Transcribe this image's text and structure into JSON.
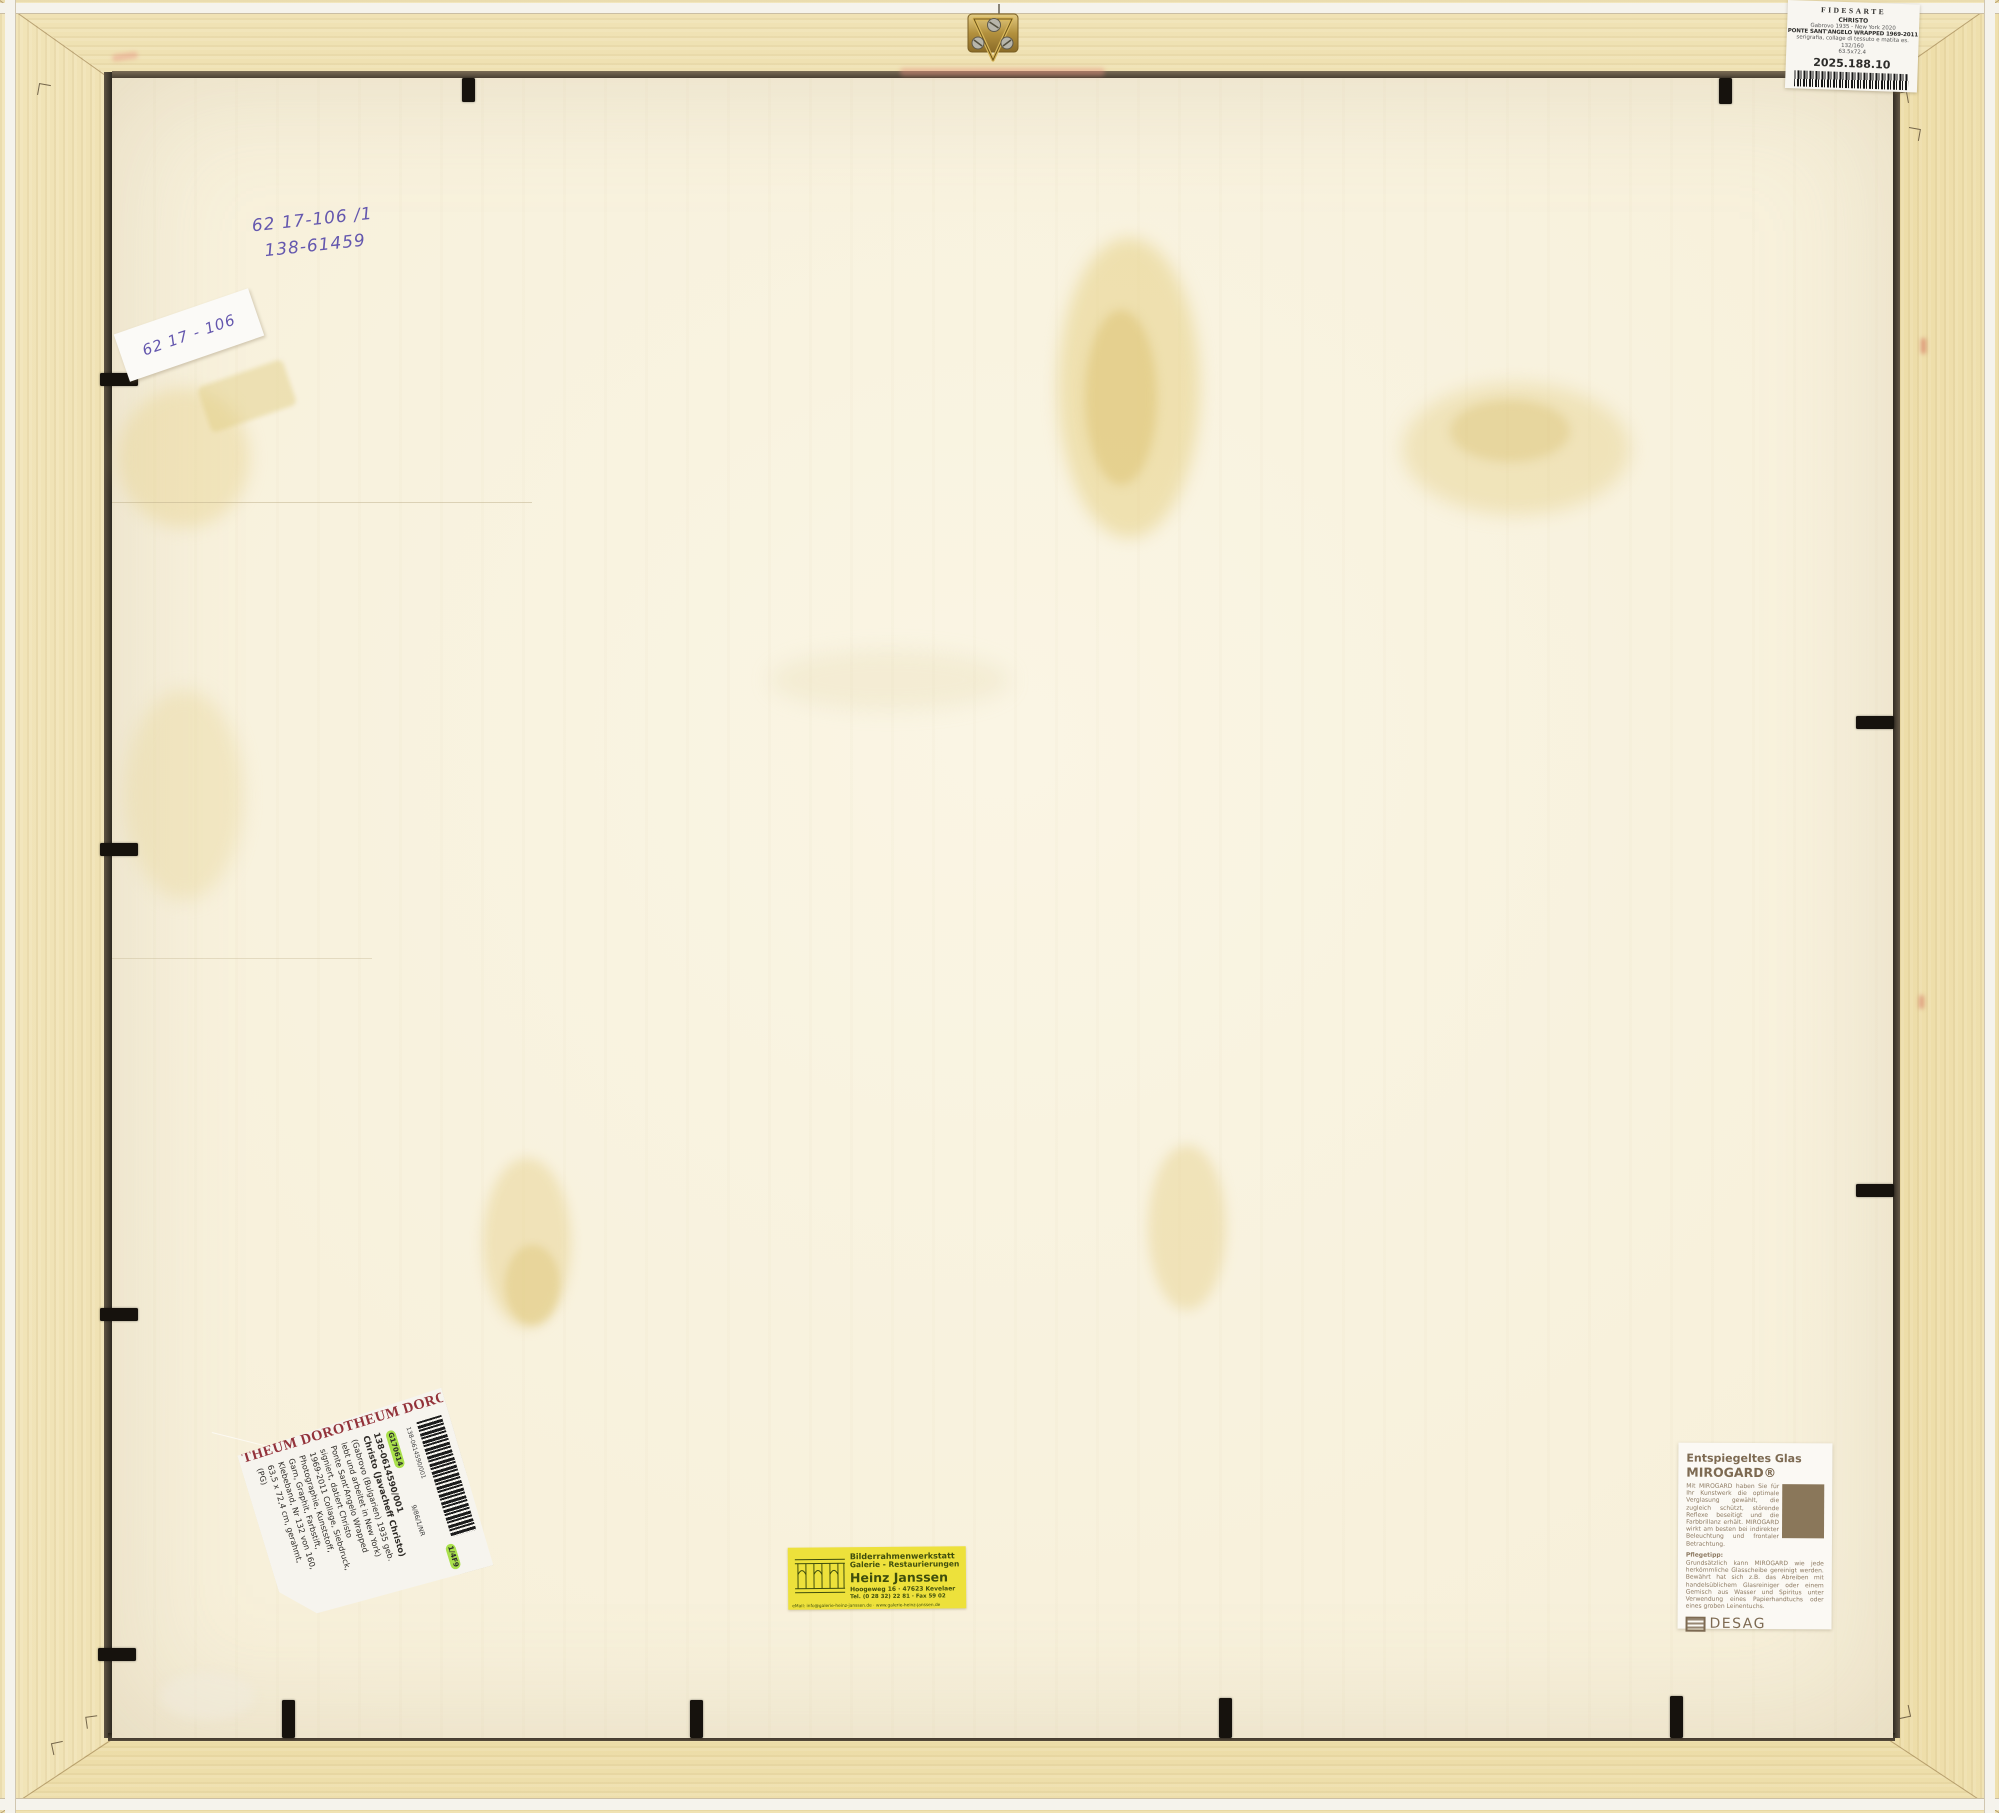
{
  "colors": {
    "wood": "#ecdca6",
    "board": "#f8f2df",
    "frame_lip": "#f5f3ec",
    "label_yellow": "#ede13b",
    "dorotheum_red": "#93323a",
    "badge_green": "#a9e04b",
    "ink_blue": "#6457ae",
    "mirogard_brown": "#7d6a52",
    "janssen_green": "#3f4e0c"
  },
  "handwriting": {
    "line1": "62 17-106 /1",
    "line2": "138-61459",
    "sticker_text": "62 17 - 106"
  },
  "fidesarte_label": {
    "brand": "FIDESARTE",
    "artist": "CHRISTO",
    "dates": "Gabrovo 1935 - New York 2020",
    "title": "PONTE SANT'ANGELO WRAPPED 1969-2011",
    "medium": "serigrafia, collage di tessuto e matita es. 132/160",
    "size": "63.5x72.4",
    "accession": "2025.188.10"
  },
  "dorotheum_label": {
    "header": "THEUM DOROTHEUM DOROTHEUM",
    "badge_top": "G170614",
    "side_number": "9/86/1/NR",
    "badge_bottom": "1/4F9",
    "barcode_number": "138-0614590/001",
    "lines": [
      "138-0614590/001",
      "Christo (Javacheff Christo)",
      "(Gabrovo (Bulgarien) 1935 geb.",
      "lebt und arbeitet in New York)",
      "Ponte Sant'Angelo Wrapped",
      "signiert, datiert Christo",
      "1969-2011 Collage, Siebdruck,",
      "Photographie, Kunststoff,",
      "Garn, Graphit, Farbstift,",
      "Klebeband, Nr 132 von 160,",
      "63,5 x 72,4 cm, gerahmt,",
      "(PG)"
    ]
  },
  "janssen_label": {
    "line1": "Bilderrahmenwerkstatt",
    "line2": "Galerie - Restaurierungen",
    "name": "Heinz Janssen",
    "address": "Hoogeweg 16 · 47623 Kevelaer",
    "phone": "Tel. (0 28 32) 22 81 · Fax 59 02",
    "email_line": "eMail: info@galerie-heinz-janssen.de · www.galerie-heinz-janssen.de"
  },
  "mirogard_label": {
    "title_line1": "Entspiegeltes Glas",
    "title_line2": "MIROGARD®",
    "intro": "Mit MIROGARD haben Sie für Ihr Kunstwerk die optimale Verglasung gewählt, die zugleich schützt, störende Reflexe beseitigt und die Farbbrillanz erhält. MIROGARD wirkt am besten bei indirekter Beleuchtung und frontaler Betrachtung.",
    "tip_heading": "Pflegetipp:",
    "tip_text": "Grundsätzlich kann MIROGARD wie jede herkömmliche Glasscheibe gereinigt werden. Bewährt hat sich z.B. das Abreiben mit handelsüblichem Glasreiniger oder einem Gemisch aus Wasser und Spiritus unter Verwendung eines Papierhandtuchs oder eines groben Leinentuchs.",
    "brand": "DESAG"
  }
}
